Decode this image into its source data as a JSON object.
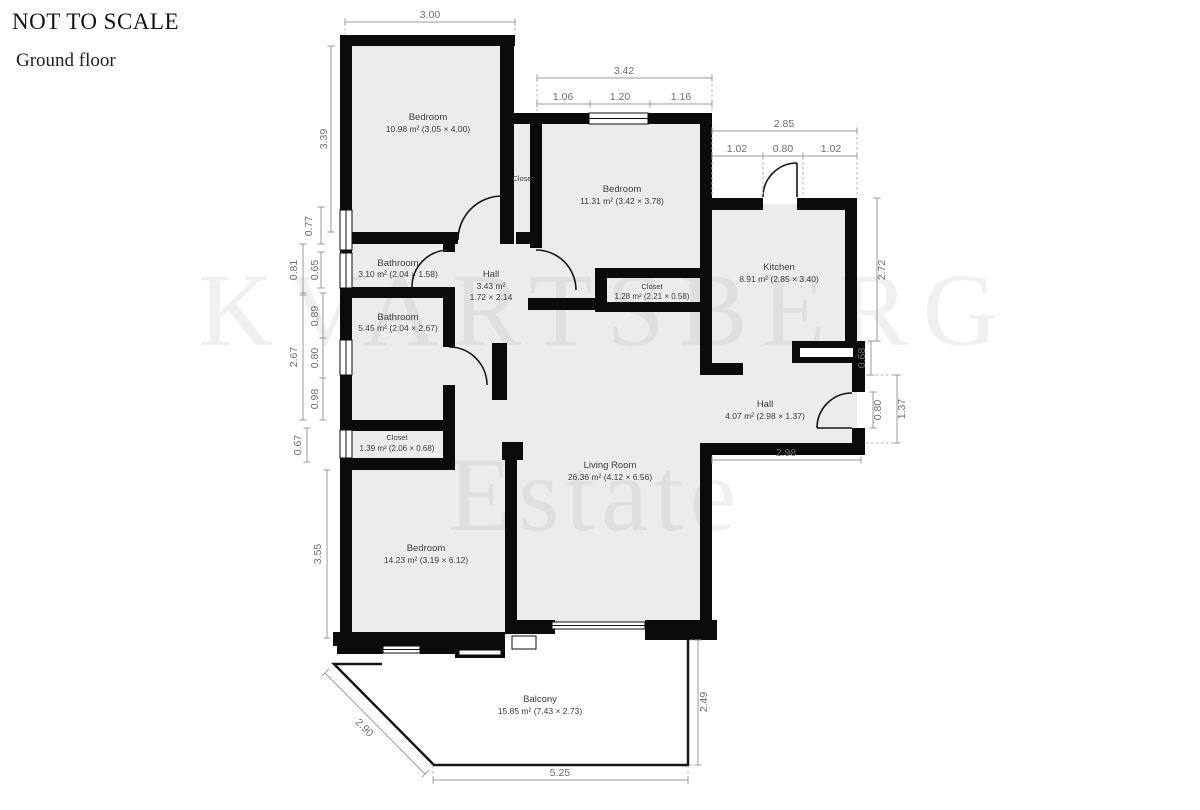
{
  "header": {
    "title": "NOT TO SCALE",
    "subtitle": "Ground floor"
  },
  "watermark": {
    "line1": "KVARTSBERG",
    "line2": "Estate"
  },
  "rooms": {
    "bedroom1": {
      "name": "Bedroom",
      "dims": "10.98 m² (3.05 × 4.00)"
    },
    "closet_top": {
      "name": "Closet"
    },
    "bedroom2": {
      "name": "Bedroom",
      "dims": "11.31 m² (3.42 × 3.78)"
    },
    "kitchen": {
      "name": "Kitchen",
      "dims": "8.91 m² (2.85 × 3.40)"
    },
    "bathroom1": {
      "name": "Bathroom",
      "dims": "3.10 m² (2.04 × 1.58)"
    },
    "hall1": {
      "name": "Hall",
      "area": "3.43 m²",
      "size": "1.72 × 2.14"
    },
    "bathroom2": {
      "name": "Bathroom",
      "dims": "5.45 m² (2.04 × 2.67)"
    },
    "closet_mid": {
      "name": "Closet",
      "dims": "1.28 m² (2.21 × 0.58)"
    },
    "closet_left": {
      "name": "Closet",
      "dims": "1.39 m² (2.06 × 0.68)"
    },
    "hall2": {
      "name": "Hall",
      "dims": "4.07 m² (2.98 × 1.37)"
    },
    "living": {
      "name": "Living Room",
      "dims": "26.36 m² (4.12 × 6.56)"
    },
    "bedroom3": {
      "name": "Bedroom",
      "dims": "14.23 m² (3.19 × 6.12)"
    },
    "balcony": {
      "name": "Balcony",
      "dims": "15.85 m² (7.43 × 2.73)"
    }
  },
  "dimensions": {
    "top_bedroom1": "3.00",
    "top_bedroom2_total": "3.42",
    "top_bedroom2_a": "1.06",
    "top_bedroom2_b": "1.20",
    "top_bedroom2_c": "1.16",
    "top_kitchen_total": "2.85",
    "top_kitchen_a": "1.02",
    "top_kitchen_b": "0.80",
    "top_kitchen_c": "1.02",
    "left_bedroom1": "3.39",
    "left_077": "0.77",
    "left_081": "0.81",
    "left_065": "0.65",
    "left_267": "2.67",
    "left_089": "0.89",
    "left_080": "0.80",
    "left_098": "0.98",
    "left_067": "0.67",
    "left_bedroom3": "3.55",
    "right_kitchen": "2.72",
    "right_068": "0.68",
    "right_door": "0.80",
    "right_hall": "1.37",
    "right_298": "2.98",
    "balcony_diag": "2.90",
    "balcony_bottom": "5.25",
    "balcony_right": "2.49"
  }
}
